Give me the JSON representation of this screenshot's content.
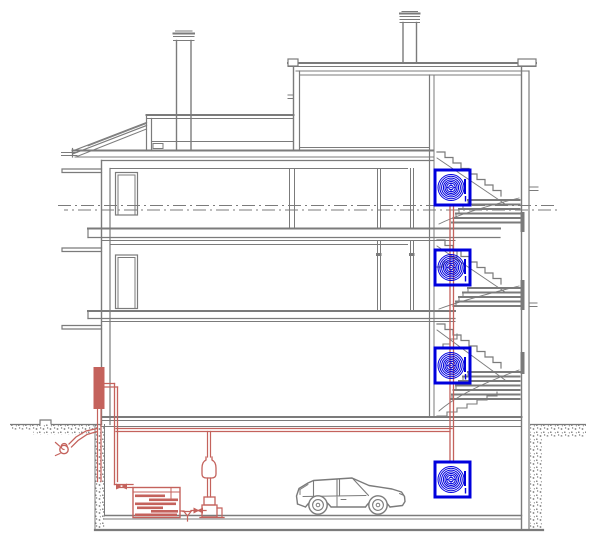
{
  "title": "Building cross-section with heating and ventilation scheme (CAD drawing)",
  "canvas": {
    "width": 615,
    "height": 545,
    "background": "#ffffff"
  },
  "colors": {
    "line": "#7b7b7b",
    "piping": "#c4625c",
    "unit": "#0000dd",
    "background": "#ffffff"
  },
  "drawing": {
    "type": "architectural-section",
    "storeys": 5,
    "chimneys": 2,
    "stair_flights": 4,
    "fan_coil_units": {
      "count": 4,
      "symbol": "square-casing-with-concentric-fan-scroll",
      "color_ref": "unit"
    },
    "heating_plant": {
      "color_ref": "piping",
      "components": [
        "wall-mounted-tank",
        "sectional-boiler",
        "circulation-pump",
        "expansion-vessel",
        "drain-funnel",
        "shut-off-valves",
        "outdoor-fill-connection",
        "supply-return-risers",
        "horizontal-distribution-main"
      ]
    },
    "vehicle": "hatchback-car-in-garage",
    "datum": "double-dash-dot-centerline",
    "ground": "stippled-earth-hatch"
  }
}
